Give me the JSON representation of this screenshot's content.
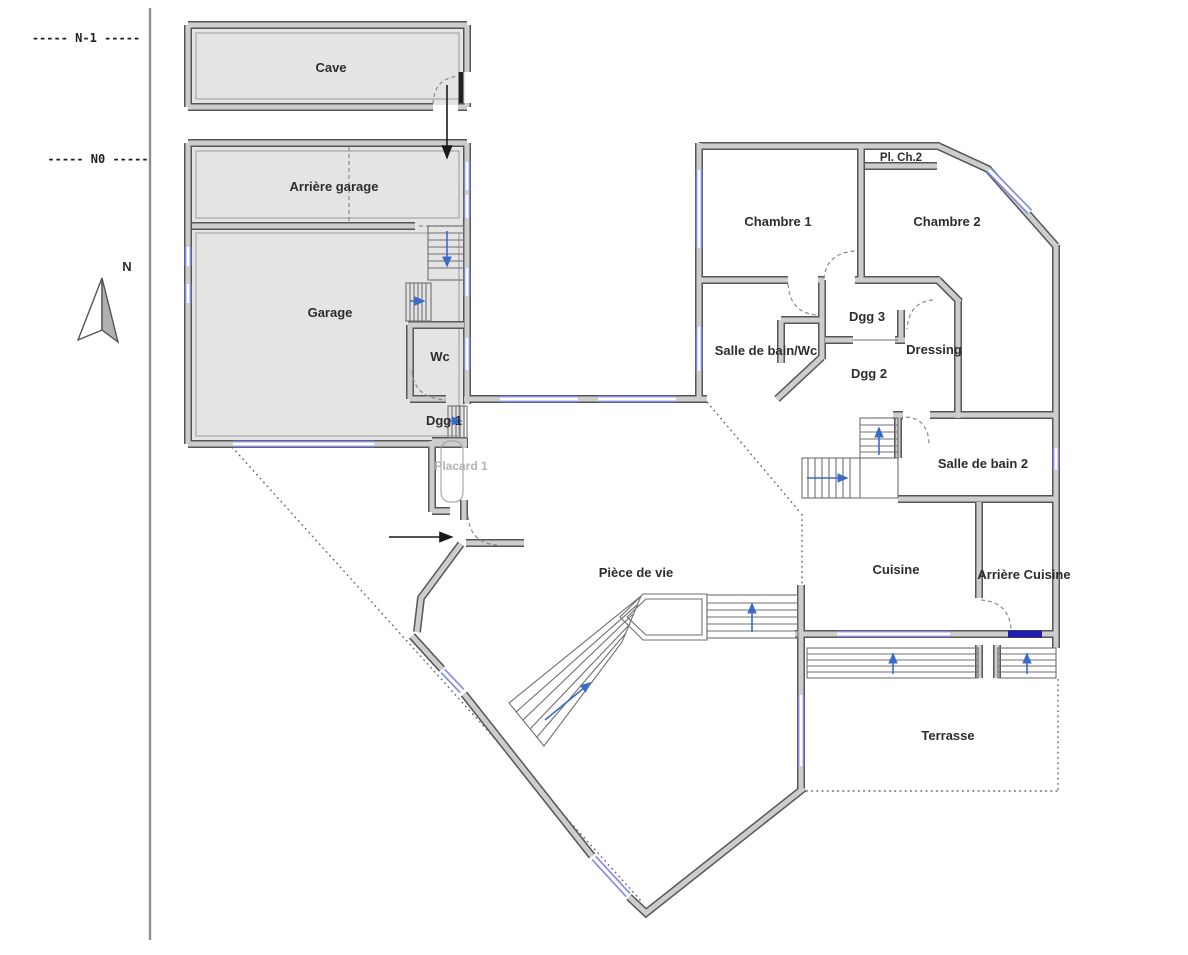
{
  "levels": {
    "n_minus_1": "----- N-1 -----",
    "n0": "----- N0 -----"
  },
  "compass": {
    "label": "N"
  },
  "rooms": {
    "cave": "Cave",
    "arriere_garage": "Arrière garage",
    "garage": "Garage",
    "wc": "Wc",
    "dgg1": "Dgg 1",
    "placard1": "Placard 1",
    "chambre1": "Chambre 1",
    "pl_ch2": "Pl. Ch.2",
    "chambre2": "Chambre 2",
    "sdb_wc": "Salle de bain/Wc",
    "dgg3": "Dgg 3",
    "dgg2": "Dgg 2",
    "dressing": "Dressing",
    "sdb2": "Salle de bain 2",
    "cuisine": "Cuisine",
    "arriere_cuisine": "Arrière Cuisine",
    "piece_de_vie": "Pièce de vie",
    "terrasse": "Terrasse"
  },
  "colors": {
    "wall_outline": "#565656",
    "wall_core": "#cdcdcd",
    "room_fill": "#e4e4e4",
    "window_blue": "#8689e8",
    "door_navy": "#1d1db0",
    "stair_arrow_blue": "#3a6bc9",
    "label_text": "#2d2d2d"
  }
}
